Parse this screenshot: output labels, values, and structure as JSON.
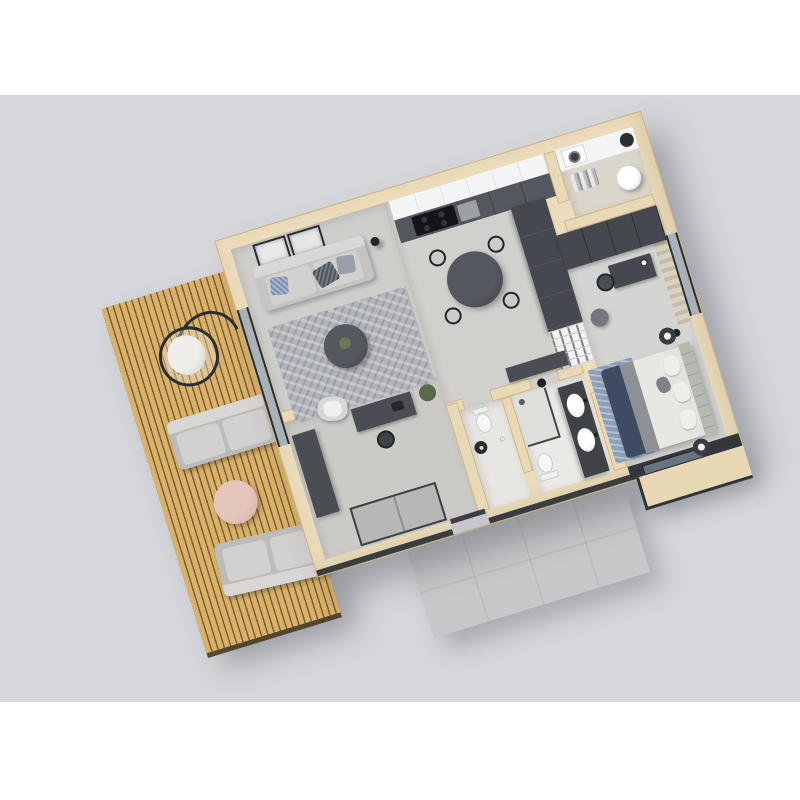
{
  "meta": {
    "title": "3D isometric floor plan render of a one-bedroom apartment with wooden terrace",
    "view": "top-down 3D floor plan, plan rotated about -17 degrees",
    "visible_text": "none"
  },
  "palette": {
    "page_background": "#ffffff",
    "render_background": "#d5d7db",
    "wall_cut": "#ecdcbb",
    "wall_edge": "#cbb283",
    "slab_edge": "#393c41",
    "deck_wood": "#d9b168",
    "deck_gap": "#7c6135",
    "floor_concrete": "#d0cfcb",
    "bath_floor": "#eae9e5",
    "graphite_furniture": "#45484e",
    "white_cabinet": "#f4f5f6",
    "living_rug": "#b1b4b9",
    "bedroom_rug": "#8ba0bb",
    "bed_navy_blanket": "#3f4b63",
    "headboard_panel": "#b6b9b0",
    "curtain": "#d6cdbb",
    "outdoor_sofa": "#d2d1cf",
    "side_table_pink": "#dcb9ae",
    "glass": "#a9b3b7"
  },
  "rooms": [
    {
      "name": "Terrace deck",
      "items": [
        "hanging egg chair",
        "outdoor sofa",
        "round pink side table",
        "outdoor sofa 2",
        "wood slat decking"
      ]
    },
    {
      "name": "Living room",
      "items": [
        "two framed wall pictures",
        "grey two-seat sofa with cushions",
        "black floor lamp",
        "textured grey rug",
        "round dark coffee table with plant",
        "lounge chair"
      ]
    },
    {
      "name": "Kitchen and dining",
      "items": [
        "white upper cabinets",
        "dark base cabinets",
        "black cooktop",
        "oven",
        "round dark dining table",
        "four black wire chairs",
        "tall graphite pantry cabinets",
        "white open bookshelf"
      ]
    },
    {
      "name": "Laundry room",
      "items": [
        "white counter",
        "washing machine",
        "water heater cylinder",
        "waste bin",
        "hanging clothes"
      ]
    },
    {
      "name": "Bedroom",
      "items": [
        "graphite wardrobe run",
        "window with curtains",
        "desk with chair and lamp",
        "grey pouf",
        "double bed with white duvet",
        "navy blanket",
        "upholstered headboard wall panel",
        "two round black nightstands with lamps",
        "blue rug",
        "glass door to balcony"
      ]
    },
    {
      "name": "Bathroom",
      "items": [
        "walk-in glass shower",
        "toilet",
        "dark double vanity",
        "two white vessel sinks",
        "black wall accessories"
      ]
    },
    {
      "name": "WC",
      "items": [
        "toilet",
        "black round wash basin",
        "paper stand"
      ]
    },
    {
      "name": "Entry hall",
      "items": [
        "desk with black chair",
        "potted plant",
        "dark bench cabinet",
        "grey sliding-door wardrobe",
        "front door opening"
      ]
    },
    {
      "name": "Balcony",
      "items": [
        "glass balustrade"
      ]
    },
    {
      "name": "Front porch",
      "items": [
        "concrete slab paving"
      ]
    }
  ]
}
